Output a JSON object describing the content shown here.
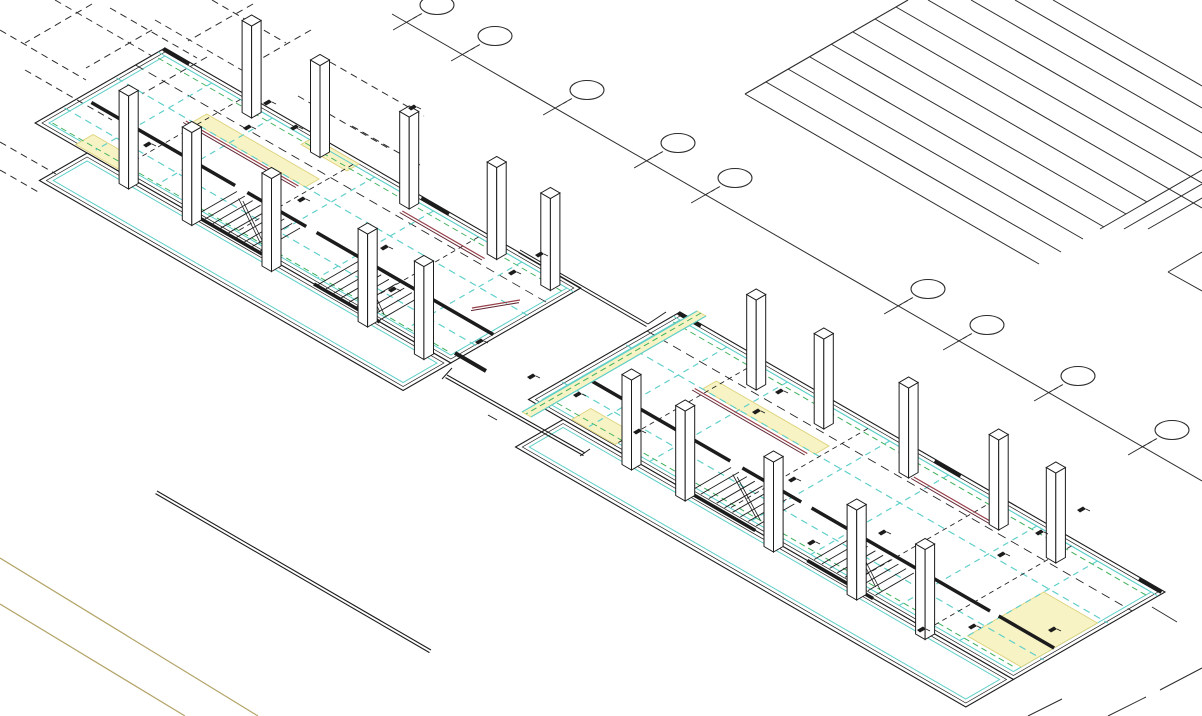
{
  "meta": {
    "description": "Isometric CAD axonometric drawing of a two-unit building floor plan with white columns, stairs, structural grid bubbles and hatched block",
    "tool": "cad-viewport"
  },
  "canvas": {
    "w": 1202,
    "h": 716,
    "bg": "#ffffff"
  },
  "palette": {
    "ink": "#1c1c1c",
    "grid": "#2b2b2b",
    "cyan": "#5ecfc9",
    "cyan_soft": "#8adfd8",
    "green": "#3cb05c",
    "yellow_fill": "#f7f3c5",
    "yellow_edge": "#ddd27a",
    "red": "#97404a",
    "red_dark": "#5f2430",
    "tan": "#b3a468",
    "white": "#ffffff"
  },
  "iso": {
    "ux": 0.866,
    "uy": 0.5,
    "colw": 11
  },
  "grid_top": {
    "axis": [
      [
        392,
        14
      ],
      [
        1202,
        481
      ]
    ],
    "ticks": [
      [
        407,
        22
      ],
      [
        465,
        53
      ],
      [
        557,
        107
      ],
      [
        648,
        160
      ],
      [
        705,
        195
      ],
      [
        898,
        306
      ],
      [
        957,
        342
      ],
      [
        1048,
        393
      ],
      [
        1142,
        447
      ]
    ],
    "bubble": {
      "dx": 30,
      "dy": -17,
      "rx": 17,
      "ry": 9.5,
      "tick_len": 16
    }
  },
  "hatch": {
    "boundary": [
      [
        908,
        0
      ],
      [
        745,
        94
      ]
    ],
    "lines": [
      [
        [
          1053,
          0
        ],
        [
          1202,
          86
        ]
      ],
      [
        [
          1015,
          0
        ],
        [
          1202,
          108
        ]
      ],
      [
        [
          971,
          0
        ],
        [
          1202,
          133
        ]
      ],
      [
        [
          928,
          0
        ],
        [
          1202,
          158
        ]
      ],
      [
        [
          896,
          7
        ],
        [
          1202,
          183
        ]
      ],
      [
        [
          875,
          19
        ],
        [
          1202,
          208
        ]
      ],
      [
        [
          853,
          32
        ],
        [
          1147,
          202
        ]
      ],
      [
        [
          831,
          44
        ],
        [
          1126,
          214
        ]
      ],
      [
        [
          810,
          57
        ],
        [
          1104,
          227
        ]
      ],
      [
        [
          788,
          69
        ],
        [
          1083,
          239
        ]
      ],
      [
        [
          766,
          82
        ],
        [
          1061,
          252
        ]
      ],
      [
        [
          745,
          94
        ],
        [
          1039,
          264
        ]
      ]
    ],
    "cross": [
      [
        [
          1202,
          170
        ],
        [
          1100,
          229
        ]
      ],
      [
        [
          1202,
          184
        ],
        [
          1124,
          229
        ]
      ],
      [
        [
          1202,
          198
        ],
        [
          1148,
          229
        ]
      ],
      [
        [
          1202,
          252
        ],
        [
          1168,
          272
        ]
      ],
      [
        [
          1168,
          272
        ],
        [
          1202,
          291
        ]
      ]
    ]
  },
  "dashed_grid": [
    [
      [
        55,
        0
      ],
      [
        152,
        56
      ]
    ],
    [
      [
        0,
        30
      ],
      [
        86,
        80
      ]
    ],
    [
      [
        110,
        8
      ],
      [
        197,
        58
      ]
    ],
    [
      [
        25,
        70
      ],
      [
        112,
        120
      ]
    ],
    [
      [
        155,
        20
      ],
      [
        252,
        76
      ]
    ],
    [
      [
        212,
        0
      ],
      [
        286,
        43
      ]
    ],
    [
      [
        330,
        62
      ],
      [
        424,
        116
      ]
    ],
    [
      [
        298,
        96
      ],
      [
        388,
        148
      ]
    ],
    [
      [
        352,
        126
      ],
      [
        420,
        165
      ]
    ],
    [
      [
        92,
        4
      ],
      [
        25,
        43
      ]
    ],
    [
      [
        152,
        30
      ],
      [
        86,
        68
      ]
    ],
    [
      [
        207,
        57
      ],
      [
        142,
        94
      ]
    ],
    [
      [
        253,
        4
      ],
      [
        188,
        41
      ]
    ],
    [
      [
        311,
        30
      ],
      [
        252,
        64
      ]
    ],
    [
      [
        0,
        142
      ],
      [
        56,
        174
      ]
    ],
    [
      [
        0,
        170
      ],
      [
        40,
        193
      ]
    ]
  ],
  "site": {
    "tan_lines": [
      [
        [
          0,
          558
        ],
        [
          258,
          716
        ]
      ],
      [
        [
          0,
          604
        ],
        [
          185,
          716
        ]
      ]
    ],
    "double_black": [
      [
        157,
        491
      ],
      [
        431,
        650
      ]
    ],
    "corner_segs": [
      [
        [
          1160,
          690
        ],
        [
          1202,
          668
        ]
      ],
      [
        [
          1108,
          716
        ],
        [
          1146,
          697
        ]
      ],
      [
        [
          1028,
          716
        ],
        [
          1062,
          699
        ]
      ],
      [
        [
          1152,
          607
        ],
        [
          1177,
          622
        ]
      ]
    ]
  },
  "connector": {
    "corridor_rails": [
      [
        [
          697,
          311
        ],
        [
          522,
          412
        ]
      ],
      [
        [
          706,
          316
        ],
        [
          531,
          417
        ]
      ]
    ],
    "corridor_fill": [
      [
        697,
        311
      ],
      [
        706,
        316
      ],
      [
        531,
        417
      ],
      [
        522,
        412
      ]
    ],
    "corridor_green": [
      [
        701,
        313
      ],
      [
        526,
        414
      ]
    ],
    "south_wall": [
      [
        447,
        375
      ],
      [
        585,
        453
      ]
    ],
    "south_caps": [
      [
        [
          442,
          379
        ],
        [
          452,
          368
        ]
      ],
      [
        [
          580,
          456
        ],
        [
          590,
          449
        ]
      ]
    ],
    "north_wall": [
      [
        520,
        250
      ],
      [
        648,
        324
      ]
    ],
    "north_jog": [
      [
        648,
        324
      ],
      [
        666,
        312
      ]
    ],
    "red_rail": [
      [
        472,
        308
      ],
      [
        520,
        300
      ]
    ],
    "thick_dash": [
      [
        455,
        353
      ],
      [
        486,
        371
      ]
    ],
    "small_tick": [
      [
        488,
        415
      ],
      [
        497,
        420
      ]
    ]
  },
  "units": [
    {
      "name": "unit-1",
      "origin": [
        165,
        48
      ],
      "slabs": [
        {
          "a0": 0,
          "a1": 480,
          "b0": 0,
          "b1": 150
        },
        {
          "a0": 60,
          "a1": 480,
          "b0": 150,
          "b1": 205
        }
      ],
      "thick": [
        {
          "b": 97,
          "w": 3.5,
          "segs": [
            [
              12,
              178
            ],
            [
              192,
              260
            ],
            [
              272,
              392
            ],
            [
              404,
              476
            ]
          ]
        },
        {
          "b": 150,
          "w": 3.5,
          "segs": [
            [
              182,
              262
            ],
            [
              322,
              398
            ]
          ]
        },
        {
          "b": 2,
          "w": 4,
          "segs": [
            [
              0,
              30
            ],
            [
              298,
              330
            ]
          ]
        }
      ],
      "ulines": [
        {
          "b": 14,
          "c": "green",
          "w": 1,
          "dash": "6,4",
          "a0": 6,
          "a1": 474
        },
        {
          "b": 140,
          "c": "green",
          "w": 1,
          "dash": "6,4",
          "a0": 10,
          "a1": 470
        },
        {
          "b": 58,
          "c": "cyan",
          "w": 1.2,
          "dash": "7,5",
          "a0": 2,
          "a1": 478
        },
        {
          "b": 118,
          "c": "cyan",
          "w": 1.2,
          "dash": "7,5",
          "a0": 2,
          "a1": 478
        },
        {
          "b": 34,
          "c": "ink",
          "w": 0.8,
          "dash": "9,6",
          "a0": 0,
          "a1": 480
        },
        {
          "b": 8,
          "c": "cyan",
          "w": 1,
          "dash": "",
          "a0": 0,
          "a1": 480
        }
      ],
      "part_b": [
        8,
        142
      ],
      "partitions": [
        {
          "a": 62,
          "c": "cyan"
        },
        {
          "a": 132,
          "c": "cyan"
        },
        {
          "a": 250,
          "c": "cyan"
        },
        {
          "a": 318,
          "c": "cyan"
        },
        {
          "a": 420,
          "c": "cyan"
        },
        {
          "a": 95,
          "c": "ink"
        },
        {
          "a": 225,
          "c": "ink"
        },
        {
          "a": 370,
          "c": "ink"
        }
      ],
      "yellow": [
        {
          "a0": 90,
          "a1": 220,
          "b0": 42,
          "b1": 58
        },
        {
          "a0": 45,
          "a1": 95,
          "b0": 128,
          "b1": 148
        },
        {
          "a0": 175,
          "a1": 228,
          "b0": 4,
          "b1": 18
        }
      ],
      "red": [
        {
          "a0": 85,
          "a1": 215,
          "b": 61
        },
        {
          "a0": 300,
          "a1": 395,
          "b": 26
        }
      ],
      "stairs": [
        {
          "a0": 185,
          "a1": 258,
          "b0": 102,
          "b1": 148,
          "n": 9
        },
        {
          "a0": 325,
          "a1": 396,
          "b0": 102,
          "b1": 148,
          "n": 9
        }
      ],
      "cols": [
        {
          "b": 20,
          "h": 92,
          "a": [
            120,
            199,
            302,
            403,
            465
          ]
        },
        {
          "b": 162,
          "h": 93,
          "a": [
            120,
            193,
            285,
            396,
            461
          ]
        }
      ]
    },
    {
      "name": "unit-2",
      "origin": [
        680,
        312
      ],
      "slabs": [
        {
          "a0": 0,
          "a1": 560,
          "b0": 0,
          "b1": 175
        },
        {
          "a0": 40,
          "a1": 560,
          "b0": 175,
          "b1": 230
        }
      ],
      "thick": [
        {
          "b": 120,
          "w": 3.5,
          "segs": [
            [
              12,
              178
            ],
            [
              192,
              260
            ],
            [
              272,
              392
            ],
            [
              404,
              478
            ],
            [
              488,
              552
            ]
          ]
        },
        {
          "b": 175,
          "w": 3.5,
          "segs": [
            [
              182,
              262
            ],
            [
              322,
              398
            ]
          ]
        },
        {
          "b": 2,
          "w": 4,
          "segs": [
            [
              0,
              26
            ],
            [
              296,
              326
            ],
            [
              532,
              558
            ]
          ]
        }
      ],
      "ulines": [
        {
          "b": 14,
          "c": "green",
          "w": 1,
          "dash": "6,4",
          "a0": 6,
          "a1": 554
        },
        {
          "b": 162,
          "c": "green",
          "w": 1,
          "dash": "6,4",
          "a0": 10,
          "a1": 550
        },
        {
          "b": 64,
          "c": "cyan",
          "w": 1.2,
          "dash": "7,5",
          "a0": 2,
          "a1": 558
        },
        {
          "b": 138,
          "c": "cyan",
          "w": 1.2,
          "dash": "7,5",
          "a0": 2,
          "a1": 558
        },
        {
          "b": 38,
          "c": "ink",
          "w": 0.8,
          "dash": "9,6",
          "a0": 0,
          "a1": 560
        },
        {
          "b": 8,
          "c": "cyan",
          "w": 1,
          "dash": "",
          "a0": 0,
          "a1": 560
        }
      ],
      "part_b": [
        8,
        167
      ],
      "partitions": [
        {
          "a": 62,
          "c": "cyan"
        },
        {
          "a": 132,
          "c": "cyan"
        },
        {
          "a": 250,
          "c": "cyan"
        },
        {
          "a": 318,
          "c": "cyan"
        },
        {
          "a": 420,
          "c": "cyan"
        },
        {
          "a": 490,
          "c": "cyan"
        },
        {
          "a": 95,
          "c": "ink"
        },
        {
          "a": 225,
          "c": "ink"
        },
        {
          "a": 370,
          "c": "ink"
        },
        {
          "a": 460,
          "c": "ink"
        }
      ],
      "yellow": [
        {
          "a0": 90,
          "a1": 220,
          "b0": 48,
          "b1": 64
        },
        {
          "a0": 45,
          "a1": 95,
          "b0": 148,
          "b1": 170
        },
        {
          "a0": 490,
          "a1": 552,
          "b0": 70,
          "b1": 158
        }
      ],
      "red": [
        {
          "a0": 85,
          "a1": 215,
          "b": 68
        },
        {
          "a0": 300,
          "a1": 395,
          "b": 30
        }
      ],
      "stairs": [
        {
          "a0": 185,
          "a1": 258,
          "b0": 126,
          "b1": 170,
          "n": 9
        },
        {
          "a0": 325,
          "a1": 396,
          "b0": 126,
          "b1": 170,
          "n": 9
        }
      ],
      "cols": [
        {
          "b": 34,
          "h": 90,
          "a": [
            122,
            200,
            298,
            402,
            468
          ]
        },
        {
          "b": 186,
          "h": 90,
          "a": [
            130,
            192,
            294,
            390,
            469
          ]
        }
      ]
    }
  ],
  "markers": [
    [
      263,
      103
    ],
    [
      243,
      128
    ],
    [
      290,
      128
    ],
    [
      143,
      145
    ],
    [
      297,
      200
    ],
    [
      380,
      248
    ],
    [
      388,
      290
    ],
    [
      408,
      108
    ],
    [
      508,
      273
    ],
    [
      535,
      255
    ],
    [
      475,
      342
    ],
    [
      527,
      377
    ],
    [
      573,
      395
    ],
    [
      633,
      432
    ],
    [
      752,
      412
    ],
    [
      775,
      392
    ],
    [
      788,
      480
    ],
    [
      807,
      543
    ],
    [
      878,
      533
    ],
    [
      997,
      555
    ],
    [
      1035,
      533
    ],
    [
      1077,
      510
    ],
    [
      968,
      627
    ],
    [
      1048,
      630
    ],
    [
      917,
      630
    ]
  ]
}
